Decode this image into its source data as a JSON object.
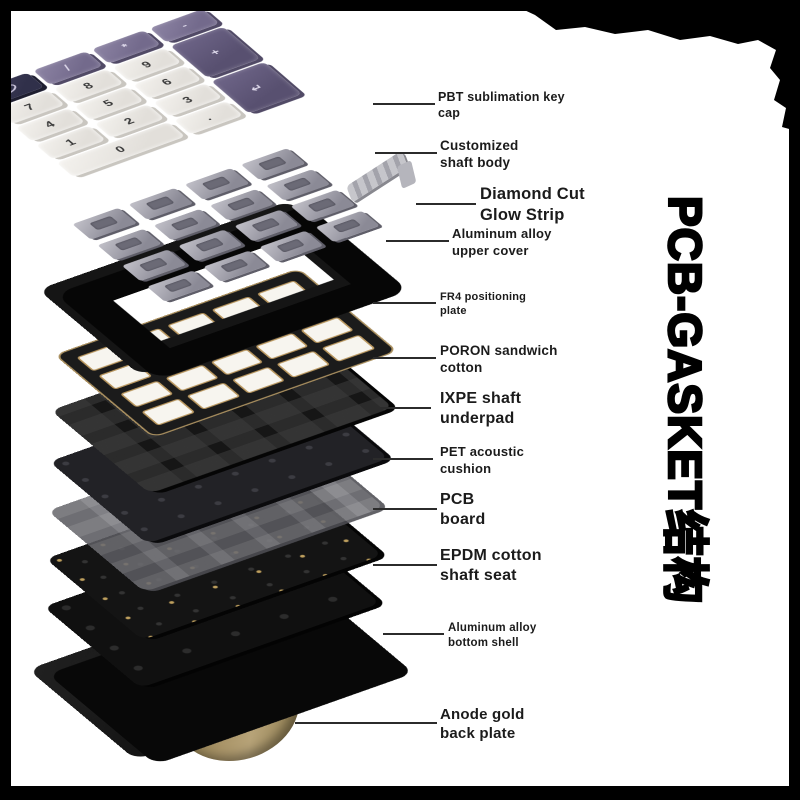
{
  "page": {
    "title_vertical": "PCB-GASKET结构",
    "background_color": "#ffffff",
    "frame_color": "#000000"
  },
  "colors": {
    "gold_accent": "#a99468",
    "fr4_trace_gold": "#b9975f",
    "keycap_white": "#ece9e4",
    "keycap_purple": "#7b7292",
    "keycap_dark": "#363450",
    "plate_black": "#141414",
    "pet_gray": "#6e6e74"
  },
  "callouts": [
    {
      "line1": "PBT sublimation key",
      "line2": "cap"
    },
    {
      "line1": "Customized",
      "line2": "shaft body"
    },
    {
      "line1": "Diamond Cut",
      "line2": "Glow Strip"
    },
    {
      "line1": "Aluminum alloy",
      "line2": "upper cover"
    },
    {
      "line1": "FR4 positioning",
      "line2": "plate"
    },
    {
      "line1": "PORON sandwich",
      "line2": "cotton"
    },
    {
      "line1": "IXPE shaft",
      "line2": "underpad"
    },
    {
      "line1": "PET acoustic",
      "line2": "cushion"
    },
    {
      "line1": "PCB",
      "line2": "board"
    },
    {
      "line1": "EPDM cotton",
      "line2": "shaft seat"
    },
    {
      "line1": "Aluminum alloy",
      "line2": "bottom shell"
    },
    {
      "line1": "Anode gold",
      "line2": "back plate"
    }
  ],
  "keypad": {
    "keys": [
      {
        "label": "",
        "style": "dark"
      },
      {
        "label": "/",
        "style": "purple"
      },
      {
        "label": "*",
        "style": "purple"
      },
      {
        "label": "-",
        "style": "purple"
      },
      {
        "label": "7",
        "style": "white"
      },
      {
        "label": "8",
        "style": "white"
      },
      {
        "label": "9",
        "style": "white"
      },
      {
        "label": "+",
        "style": "purple tall"
      },
      {
        "label": "4",
        "style": "white"
      },
      {
        "label": "5",
        "style": "white"
      },
      {
        "label": "6",
        "style": "white"
      },
      {
        "label": "1",
        "style": "white"
      },
      {
        "label": "2",
        "style": "white"
      },
      {
        "label": "3",
        "style": "white"
      },
      {
        "label": "↵",
        "style": "purple tall"
      },
      {
        "label": "0",
        "style": "white wide"
      },
      {
        "label": ".",
        "style": "white"
      }
    ]
  }
}
